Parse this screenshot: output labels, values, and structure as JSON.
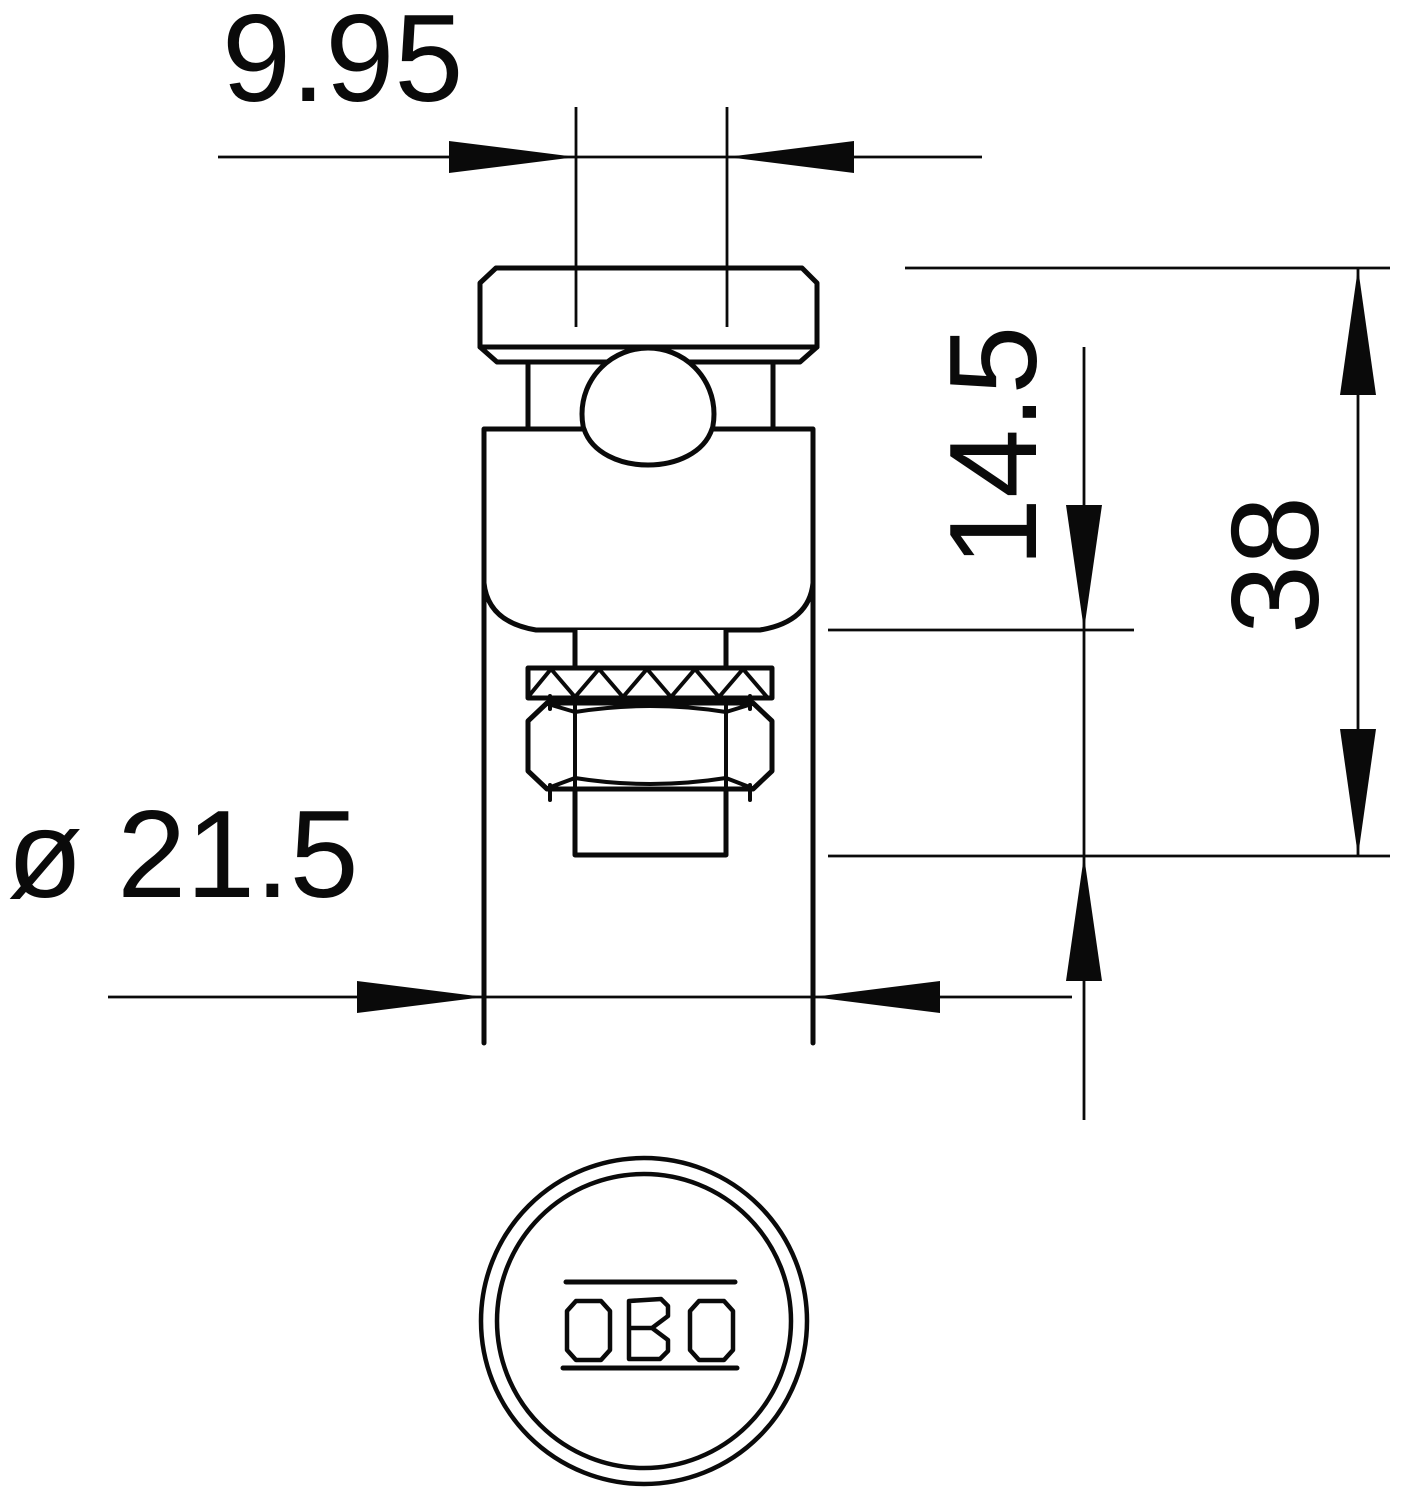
{
  "drawing": {
    "type": "technical-dimension-drawing",
    "views": {
      "front_view": "clamping bolt with ball, body, serrated washer, hex nut and threaded stud",
      "bottom_view": "circular face with brand logo"
    },
    "dimensions": {
      "stud_width": "9.95",
      "stud_protrusion": "14.5",
      "total_height": "38",
      "body_diameter": "ø 21.5"
    },
    "logo_text": "OBO",
    "colors": {
      "line": "#0a0a0a",
      "background": "#ffffff"
    }
  }
}
